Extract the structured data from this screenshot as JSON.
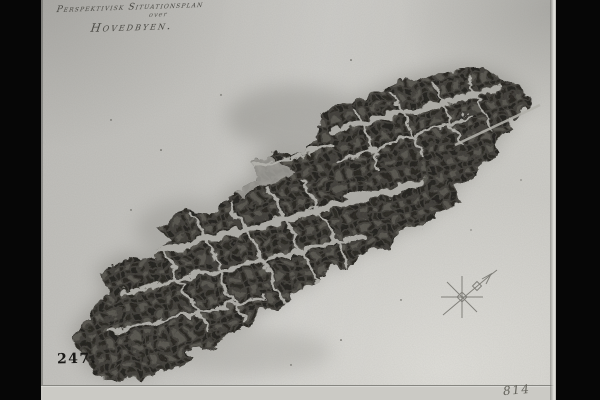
{
  "photo": {
    "caption": {
      "line1": "Perspektivisk Situationsplan",
      "line2": "over",
      "line3": "Hovedbyen."
    },
    "handwritten_numbers": {
      "bottom_left": "247.",
      "bottom_right": "814"
    },
    "compass": {
      "pointer_direction": "NE"
    },
    "colors": {
      "letterbox": "#060606",
      "paper": "#c7c6c2",
      "town_ink": "#2a2925",
      "street_light": "#b3b2ac",
      "caption_ink": "#4b4a45",
      "number_ink": "#191816",
      "pencil": "#73726c"
    }
  }
}
